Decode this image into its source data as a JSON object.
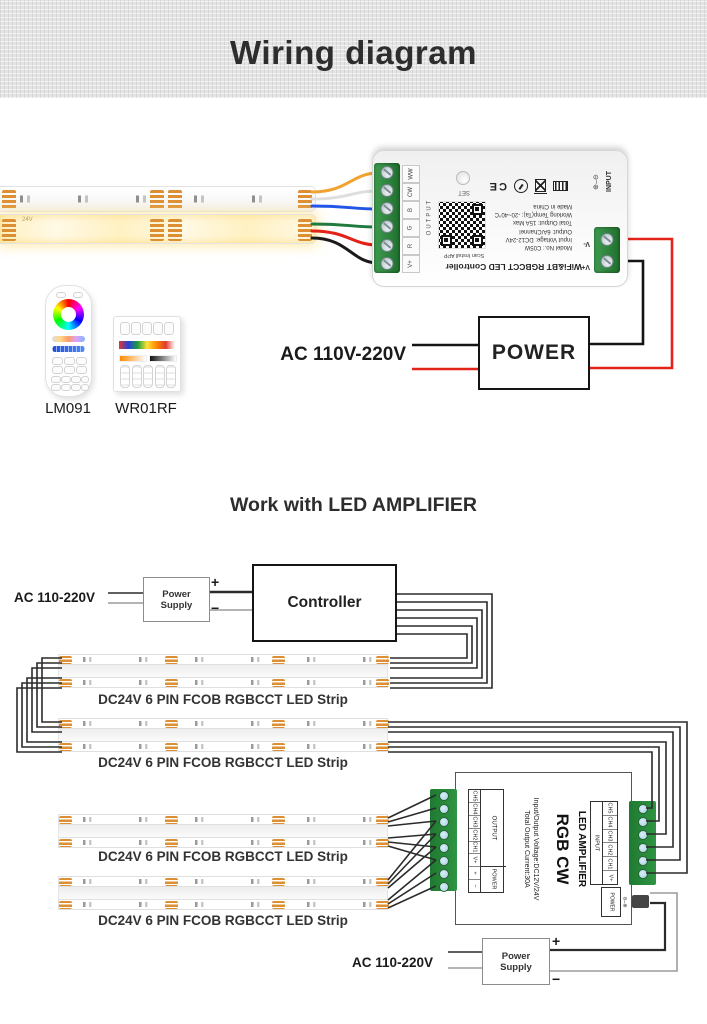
{
  "header": {
    "title": "Wiring diagram"
  },
  "colors": {
    "wire_yellow": "#f0a330",
    "wire_white": "#e9e9e9",
    "wire_blue": "#2356e8",
    "wire_green": "#1f7a3d",
    "wire_red": "#e32219",
    "wire_black": "#1a1a1a",
    "wire_gray": "#9c9c9c",
    "terminal_green": "#2e8b3d",
    "pad_orange": "#dd8f33"
  },
  "top": {
    "ac": "AC 110V-220V",
    "power": "POWER",
    "strip_mark": "24V",
    "controller": {
      "title": "WiFi&BT RGBCCT LED Controller",
      "specs": [
        "Model No.: C05W",
        "Input Voltage: DC12-24V",
        "Output: 6A/Channel",
        "Total Output: 15A Max",
        "Working Temp(Ta): -20~40°C",
        "Made in China"
      ],
      "scan": "Scan Install APP",
      "set": "SET",
      "output": "OUTPUT",
      "input": "INPUT",
      "ce": "CE",
      "out_terms": [
        "WW",
        "CW",
        "B",
        "G",
        "R",
        "V+"
      ],
      "in_terms": [
        "V-",
        "V+"
      ]
    },
    "remotes": [
      {
        "model": "LM091"
      },
      {
        "model": "WR01RF"
      }
    ]
  },
  "amp": {
    "title": "Work with LED AMPLIFIER",
    "ac": "AC 110-220V",
    "ps": "Power Supply",
    "controller": "Controller",
    "plus": "+",
    "minus": "−",
    "strip_label": "DC24V 6 PIN FCOB RGBCCT LED Strip",
    "device": {
      "name": "RGB CW",
      "type": "LED AMPLIFIER",
      "spec1": "Input/Output Voltage:DC12V/24V",
      "spec2": "Total Output Current:30A",
      "output": "OUTPUT",
      "input": "INPUT",
      "power": "POWER",
      "channels": [
        "CH5",
        "CH4",
        "CH3",
        "CH2",
        "CH1",
        "V+"
      ],
      "ppins": [
        "+",
        "−"
      ]
    }
  }
}
